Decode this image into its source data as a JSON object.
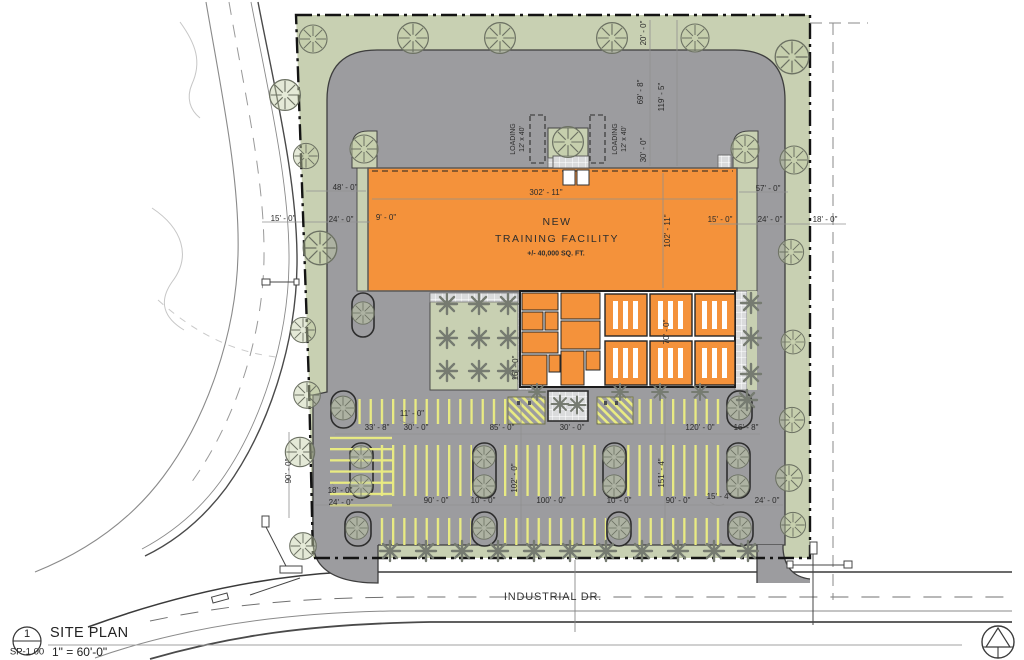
{
  "sheet": {
    "detail_number": "1",
    "sheet_number": "SP-1.00",
    "title": "SITE PLAN",
    "scale": "1\" = 60'-0\"",
    "road_name": "INDUSTRIAL DR."
  },
  "building": {
    "line1": "NEW",
    "line2": "TRAINING FACILITY",
    "line3": "+/- 40,000 SQ. FT.",
    "width_dim": "302' - 11\"",
    "depth_dim": "102' - 11\""
  },
  "loading": {
    "line1": "LOADING",
    "line2": "12' x 40'"
  },
  "colors": {
    "landscape": "#c8d0b2",
    "pavement": "#9c9c9f",
    "building": "#f4923b",
    "stripe": "#e9eb82",
    "walkway": "#d8d9da",
    "curb": "#3e3e3e"
  },
  "dims": [
    {
      "text": "20' - 0\""
    },
    {
      "text": "69' - 8\""
    },
    {
      "text": "119' - 5\""
    },
    {
      "text": "30' - 0\""
    },
    {
      "text": "48' - 0\""
    },
    {
      "text": "15' - 0\""
    },
    {
      "text": "24' - 0\""
    },
    {
      "text": "9' - 0\""
    },
    {
      "text": "57' - 0\""
    },
    {
      "text": "15' - 0\""
    },
    {
      "text": "24' - 0\""
    },
    {
      "text": "18' - 0\""
    },
    {
      "text": "16' - 0\""
    },
    {
      "text": "70' - 0\""
    },
    {
      "text": "11' - 0\""
    },
    {
      "text": "33' - 8\""
    },
    {
      "text": "30' - 0\""
    },
    {
      "text": "85' - 0\""
    },
    {
      "text": "30' - 0\""
    },
    {
      "text": "120' - 0\""
    },
    {
      "text": "16' - 8\""
    },
    {
      "text": "18' - 0\""
    },
    {
      "text": "24' - 0\""
    },
    {
      "text": "90' - 0\""
    },
    {
      "text": "10' - 0\""
    },
    {
      "text": "100' - 0\""
    },
    {
      "text": "10' - 0\""
    },
    {
      "text": "90' - 0\""
    },
    {
      "text": "15' - 4\""
    },
    {
      "text": "24' - 0\""
    },
    {
      "text": "102' - 0\""
    },
    {
      "text": "151' - 4\""
    },
    {
      "text": "90' - 0\""
    }
  ]
}
